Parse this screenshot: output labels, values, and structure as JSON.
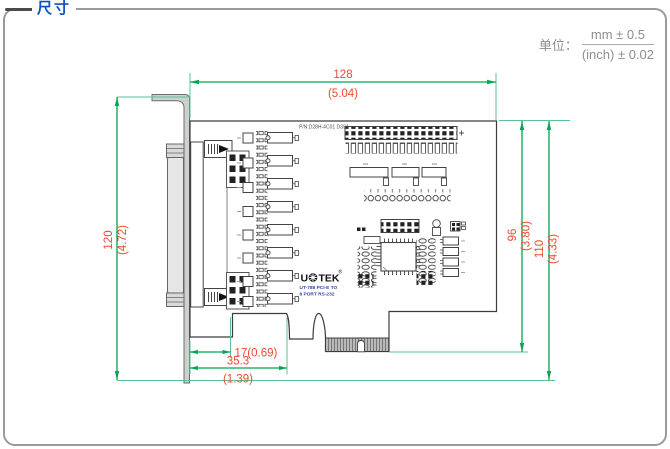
{
  "panel": {
    "title": "尺寸"
  },
  "units": {
    "label": "单位：",
    "metric": "mm ± 0.5",
    "imperial": "(inch) ± 0.02"
  },
  "board": {
    "part_number": "P/N:D28H-4C01 D3S1",
    "logo_prefix": "U",
    "logo_suffix": "TEK",
    "logo_reg": "®",
    "model_line1": "UT-788 PCI-E TO",
    "model_line2": "8 PORT RS-232"
  },
  "dimensions": {
    "width_mm": "128",
    "width_inch": "(5.04)",
    "height_mm": "120",
    "height_inch": "(4.72)",
    "board_height_mm": "96",
    "board_height_inch": "(3.80)",
    "overall_height_mm": "110",
    "overall_height_inch": "(4.33)",
    "tab_offset": "17(0.69)",
    "connector_offset_mm": "35.3",
    "connector_offset_inch": "(1.39)"
  },
  "colors": {
    "accent_blue": "#0a52c4",
    "dimension_red": "#ee4a31",
    "dimension_green": "#00a651",
    "extension_green": "#5fc191",
    "bracket_gray": "#cfcfcf"
  }
}
